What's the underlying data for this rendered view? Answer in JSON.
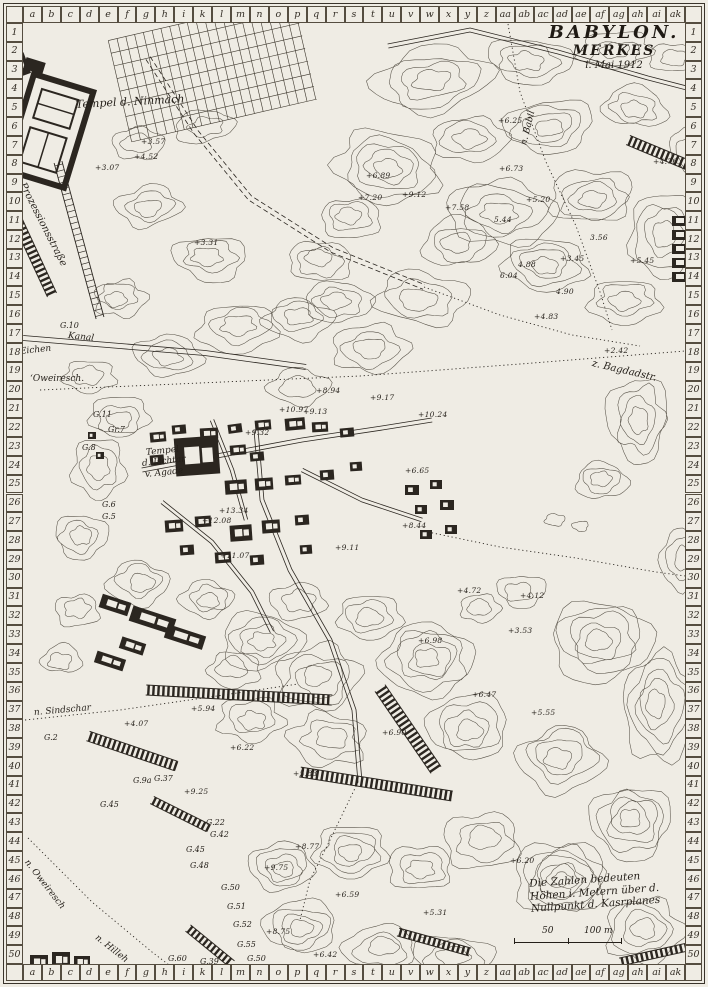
{
  "title": {
    "line1": "BABYLON.",
    "line2": "MERKES",
    "line3": "i. Mai 1912"
  },
  "frame": {
    "col_letters": [
      "a",
      "b",
      "c",
      "d",
      "e",
      "f",
      "g",
      "h",
      "i",
      "k",
      "l",
      "m",
      "n",
      "o",
      "p",
      "q",
      "r",
      "s",
      "t",
      "u",
      "v",
      "w",
      "x",
      "y",
      "z",
      "aa",
      "ab",
      "ac",
      "ad",
      "ae",
      "af",
      "ag",
      "ah",
      "ai",
      "ak"
    ],
    "row_start": 1,
    "row_end": 50
  },
  "legend": {
    "line1": "Die Zahlen bedeuten",
    "line2": "Höhen i. Metern über d.",
    "line3": "Nullpunkt d. Kasrplanes",
    "scale": {
      "left": "50",
      "right": "100 m"
    }
  },
  "colors": {
    "paper": "#efece4",
    "ink": "#2b2620",
    "contour": "#3c362c"
  },
  "labels": [
    {
      "t": "Tempel d. Ninmach",
      "x": 76,
      "y": 98,
      "r": -3,
      "s": 11
    },
    {
      "t": "Prozessionsstraße",
      "x": 22,
      "y": 178,
      "r": 63,
      "s": 10
    },
    {
      "t": "G.10",
      "x": 60,
      "y": 321,
      "r": 0,
      "s": 8
    },
    {
      "t": "Kanal",
      "x": 68,
      "y": 331,
      "r": 6,
      "s": 9
    },
    {
      "t": "Eichen",
      "x": 20,
      "y": 347,
      "r": -6,
      "s": 9
    },
    {
      "t": "ʻOweiresch.",
      "x": 30,
      "y": 374,
      "r": 0,
      "s": 9
    },
    {
      "t": "n. Babil",
      "x": 524,
      "y": 140,
      "r": -76,
      "s": 9
    },
    {
      "t": "z. Bagdadstr.",
      "x": 592,
      "y": 358,
      "r": 13,
      "s": 10
    },
    {
      "t": "Tempel",
      "x": 146,
      "y": 448,
      "r": -6,
      "s": 9
    },
    {
      "t": "d. Ischtar",
      "x": 142,
      "y": 459,
      "r": -6,
      "s": 9
    },
    {
      "t": "v. Agade",
      "x": 145,
      "y": 470,
      "r": -6,
      "s": 9
    },
    {
      "t": "G.11",
      "x": 93,
      "y": 410,
      "r": 0,
      "s": 8
    },
    {
      "t": "Gr.7",
      "x": 108,
      "y": 425,
      "r": 0,
      "s": 8
    },
    {
      "t": "G.8",
      "x": 82,
      "y": 443,
      "r": 0,
      "s": 8
    },
    {
      "t": "G.6",
      "x": 102,
      "y": 500,
      "r": 0,
      "s": 8
    },
    {
      "t": "G.5",
      "x": 102,
      "y": 512,
      "r": 0,
      "s": 8
    },
    {
      "t": "n. Sindschar",
      "x": 34,
      "y": 708,
      "r": -5,
      "s": 9
    },
    {
      "t": "G.2",
      "x": 44,
      "y": 733,
      "r": 0,
      "s": 8
    },
    {
      "t": "G.9a",
      "x": 133,
      "y": 776,
      "r": 0,
      "s": 8
    },
    {
      "t": "G.37",
      "x": 154,
      "y": 774,
      "r": 0,
      "s": 8
    },
    {
      "t": "G.45",
      "x": 100,
      "y": 800,
      "r": 0,
      "s": 8
    },
    {
      "t": "G.22",
      "x": 206,
      "y": 818,
      "r": 0,
      "s": 8
    },
    {
      "t": "G.42",
      "x": 210,
      "y": 830,
      "r": 0,
      "s": 8
    },
    {
      "t": "G.45",
      "x": 186,
      "y": 845,
      "r": 0,
      "s": 8
    },
    {
      "t": "G.48",
      "x": 190,
      "y": 861,
      "r": 0,
      "s": 8
    },
    {
      "t": "G.50",
      "x": 221,
      "y": 883,
      "r": 0,
      "s": 8
    },
    {
      "t": "G.51",
      "x": 227,
      "y": 902,
      "r": 0,
      "s": 8
    },
    {
      "t": "G.52",
      "x": 233,
      "y": 920,
      "r": 0,
      "s": 8
    },
    {
      "t": "G.55",
      "x": 237,
      "y": 940,
      "r": 0,
      "s": 8
    },
    {
      "t": "G.50",
      "x": 247,
      "y": 954,
      "r": 0,
      "s": 8
    },
    {
      "t": "G.39",
      "x": 200,
      "y": 957,
      "r": 0,
      "s": 8
    },
    {
      "t": "G.60",
      "x": 168,
      "y": 954,
      "r": 0,
      "s": 8
    },
    {
      "t": "n. Oweiresch",
      "x": 26,
      "y": 856,
      "r": 52,
      "s": 9
    },
    {
      "t": "n. Hilleh",
      "x": 96,
      "y": 932,
      "r": 38,
      "s": 9
    }
  ],
  "elevations": [
    {
      "v": "+3.57",
      "x": 141,
      "y": 137
    },
    {
      "v": "+4.52",
      "x": 134,
      "y": 152
    },
    {
      "v": "+3.07",
      "x": 95,
      "y": 163
    },
    {
      "v": "+3.31",
      "x": 194,
      "y": 238
    },
    {
      "v": "+6.25",
      "x": 498,
      "y": 116
    },
    {
      "v": "+6.73",
      "x": 499,
      "y": 164
    },
    {
      "v": "+4.76",
      "x": 653,
      "y": 157
    },
    {
      "v": "+6.89",
      "x": 366,
      "y": 171
    },
    {
      "v": "+7.20",
      "x": 358,
      "y": 193
    },
    {
      "v": "+9.12",
      "x": 402,
      "y": 190
    },
    {
      "v": "+7.58",
      "x": 445,
      "y": 203
    },
    {
      "v": "+5.20",
      "x": 526,
      "y": 195
    },
    {
      "v": "5.44",
      "x": 494,
      "y": 215
    },
    {
      "v": "3.56",
      "x": 590,
      "y": 233
    },
    {
      "v": "+5.45",
      "x": 630,
      "y": 256
    },
    {
      "v": "4.88",
      "x": 518,
      "y": 260
    },
    {
      "v": "6.04",
      "x": 500,
      "y": 271
    },
    {
      "v": "+3.45",
      "x": 560,
      "y": 254
    },
    {
      "v": "4.90",
      "x": 556,
      "y": 287
    },
    {
      "v": "+4.83",
      "x": 534,
      "y": 312
    },
    {
      "v": "+2.42",
      "x": 604,
      "y": 346
    },
    {
      "v": "+8.94",
      "x": 316,
      "y": 386
    },
    {
      "v": "+9.17",
      "x": 370,
      "y": 393
    },
    {
      "v": "+10.97",
      "x": 279,
      "y": 405
    },
    {
      "v": "+9.13",
      "x": 303,
      "y": 407
    },
    {
      "v": "+10.24",
      "x": 418,
      "y": 410
    },
    {
      "v": "+9.32",
      "x": 245,
      "y": 428
    },
    {
      "v": "+6.65",
      "x": 405,
      "y": 466
    },
    {
      "v": "+13.34",
      "x": 219,
      "y": 506
    },
    {
      "v": "+12.08",
      "x": 202,
      "y": 516
    },
    {
      "v": "+11.07",
      "x": 220,
      "y": 551
    },
    {
      "v": "+9.11",
      "x": 335,
      "y": 543
    },
    {
      "v": "+8.44",
      "x": 402,
      "y": 521
    },
    {
      "v": "+4.72",
      "x": 457,
      "y": 586
    },
    {
      "v": "+4.12",
      "x": 520,
      "y": 591
    },
    {
      "v": "+3.53",
      "x": 508,
      "y": 626
    },
    {
      "v": "+6.98",
      "x": 418,
      "y": 636
    },
    {
      "v": "+6.47",
      "x": 472,
      "y": 690
    },
    {
      "v": "+5.55",
      "x": 531,
      "y": 708
    },
    {
      "v": "+5.94",
      "x": 191,
      "y": 704
    },
    {
      "v": "+4.07",
      "x": 124,
      "y": 719
    },
    {
      "v": "+6.90",
      "x": 382,
      "y": 728
    },
    {
      "v": "+6.22",
      "x": 230,
      "y": 743
    },
    {
      "v": "+5.83",
      "x": 293,
      "y": 769
    },
    {
      "v": "+9.25",
      "x": 184,
      "y": 787
    },
    {
      "v": "+8.77",
      "x": 295,
      "y": 842
    },
    {
      "v": "+9.75",
      "x": 264,
      "y": 863
    },
    {
      "v": "+8.75",
      "x": 266,
      "y": 927
    },
    {
      "v": "+6.59",
      "x": 335,
      "y": 890
    },
    {
      "v": "+5.31",
      "x": 423,
      "y": 908
    },
    {
      "v": "+6.42",
      "x": 313,
      "y": 950
    },
    {
      "v": "+6.20",
      "x": 510,
      "y": 856
    }
  ]
}
